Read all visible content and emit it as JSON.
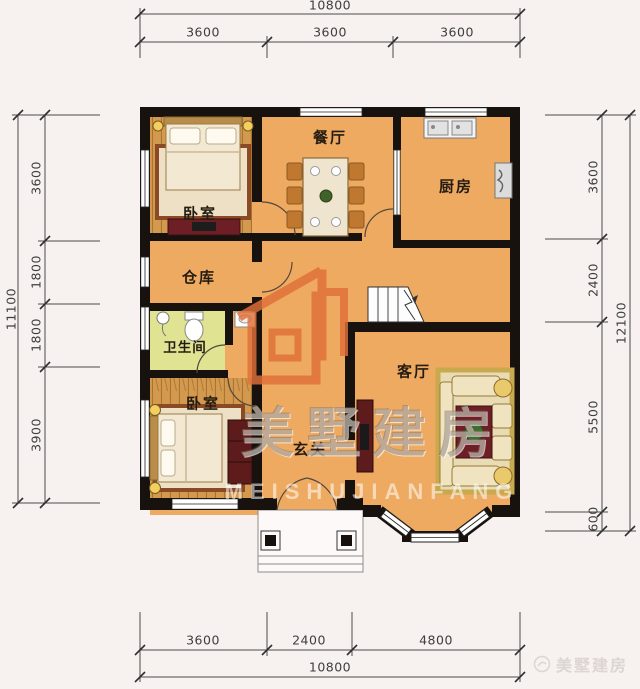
{
  "dims": {
    "top": {
      "total": "10800",
      "segments": [
        "3600",
        "3600",
        "3600"
      ]
    },
    "bottom": {
      "total": "10800",
      "segments": [
        "3600",
        "2400",
        "4800"
      ]
    },
    "left": {
      "total": "11100",
      "segments": [
        "3600",
        "1800",
        "1800",
        "3900"
      ]
    },
    "right": {
      "total": "12100",
      "segments": [
        "3600",
        "2400",
        "5500",
        "600"
      ]
    }
  },
  "rooms": {
    "bedroom_top": "卧室",
    "dining": "餐厅",
    "kitchen": "厨房",
    "storage": "仓库",
    "bathroom": "卫生间",
    "bedroom_bottom": "卧室",
    "living": "客厅",
    "foyer": "玄关"
  },
  "watermark": {
    "brand": "美墅建房",
    "latin": "MEISHUJIANFANG"
  },
  "footer": {
    "brand": "美墅建房"
  },
  "colors": {
    "background": "#f7f1f0",
    "floor": "#edaa60",
    "wood": "#d3994f",
    "bathroom_floor": "#dfe392",
    "wall": "#17120e",
    "watermark_orange": "#e0703a"
  }
}
